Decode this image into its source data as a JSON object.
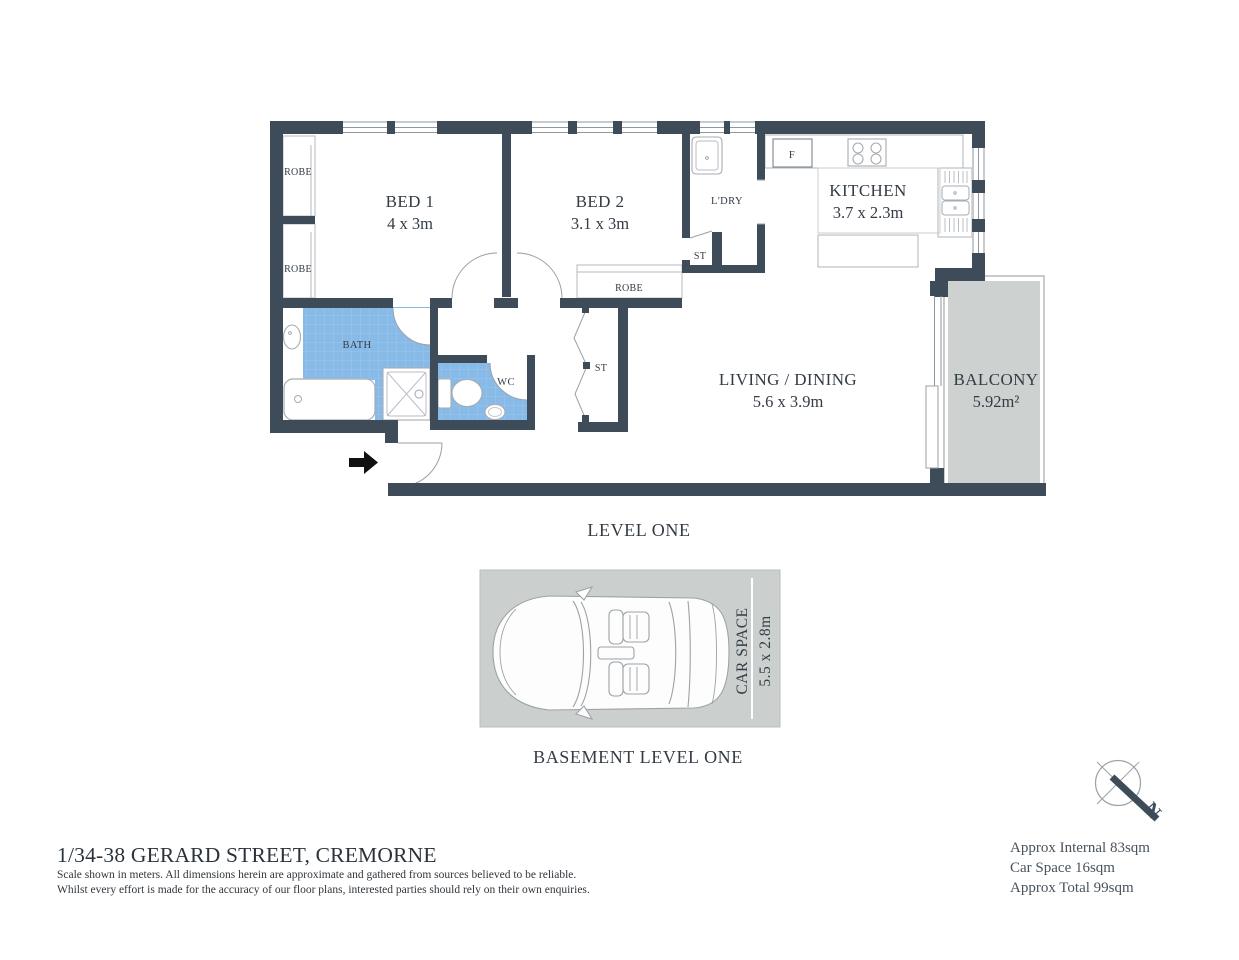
{
  "address": {
    "title": "1/34-38 GERARD STREET, CREMORNE",
    "disclaimer": [
      "Scale shown in meters. All dimensions herein are approximate and gathered from sources believed to be  reliable.",
      "Whilst every effort is made for the accuracy of our floor plans, interested parties should rely on their own enquiries."
    ]
  },
  "level_one": {
    "caption": "LEVEL ONE",
    "rooms": {
      "bed1": {
        "label": "BED 1",
        "dims": "4 x 3m"
      },
      "bed2": {
        "label": "BED 2",
        "dims": "3.1 x 3m"
      },
      "kitchen": {
        "label": "KITCHEN",
        "dims": "3.7 x 2.3m"
      },
      "living": {
        "label": "LIVING / DINING",
        "dims": "5.6 x 3.9m"
      },
      "balcony": {
        "label": "BALCONY",
        "dims": "5.92m²"
      },
      "bath": {
        "label": "BATH"
      },
      "wc": {
        "label": "WC"
      },
      "laundry": {
        "label": "L'DRY"
      },
      "robe_bed1_top": {
        "label": "ROBE"
      },
      "robe_bed1_bottom": {
        "label": "ROBE"
      },
      "robe_bed2": {
        "label": "ROBE"
      },
      "store_laundry": {
        "label": "ST"
      },
      "store_hall": {
        "label": "ST"
      },
      "fridge": {
        "label": "F"
      }
    }
  },
  "basement": {
    "caption": "BASEMENT LEVEL ONE",
    "car_space": {
      "label": "CAR SPACE",
      "dims": "5.5 x 2.8m"
    }
  },
  "summary": {
    "internal": "Approx Internal 83sqm",
    "car_space": "Car Space 16sqm",
    "total": "Approx Total 99sqm"
  },
  "compass": {
    "north_label": "N"
  },
  "colors": {
    "wall": "#3E4B58",
    "bath_tile": "#88BAE8",
    "paved_gray": "#CDD2D0",
    "fixture_line": "#A6ACB1",
    "text": "#333B44"
  }
}
